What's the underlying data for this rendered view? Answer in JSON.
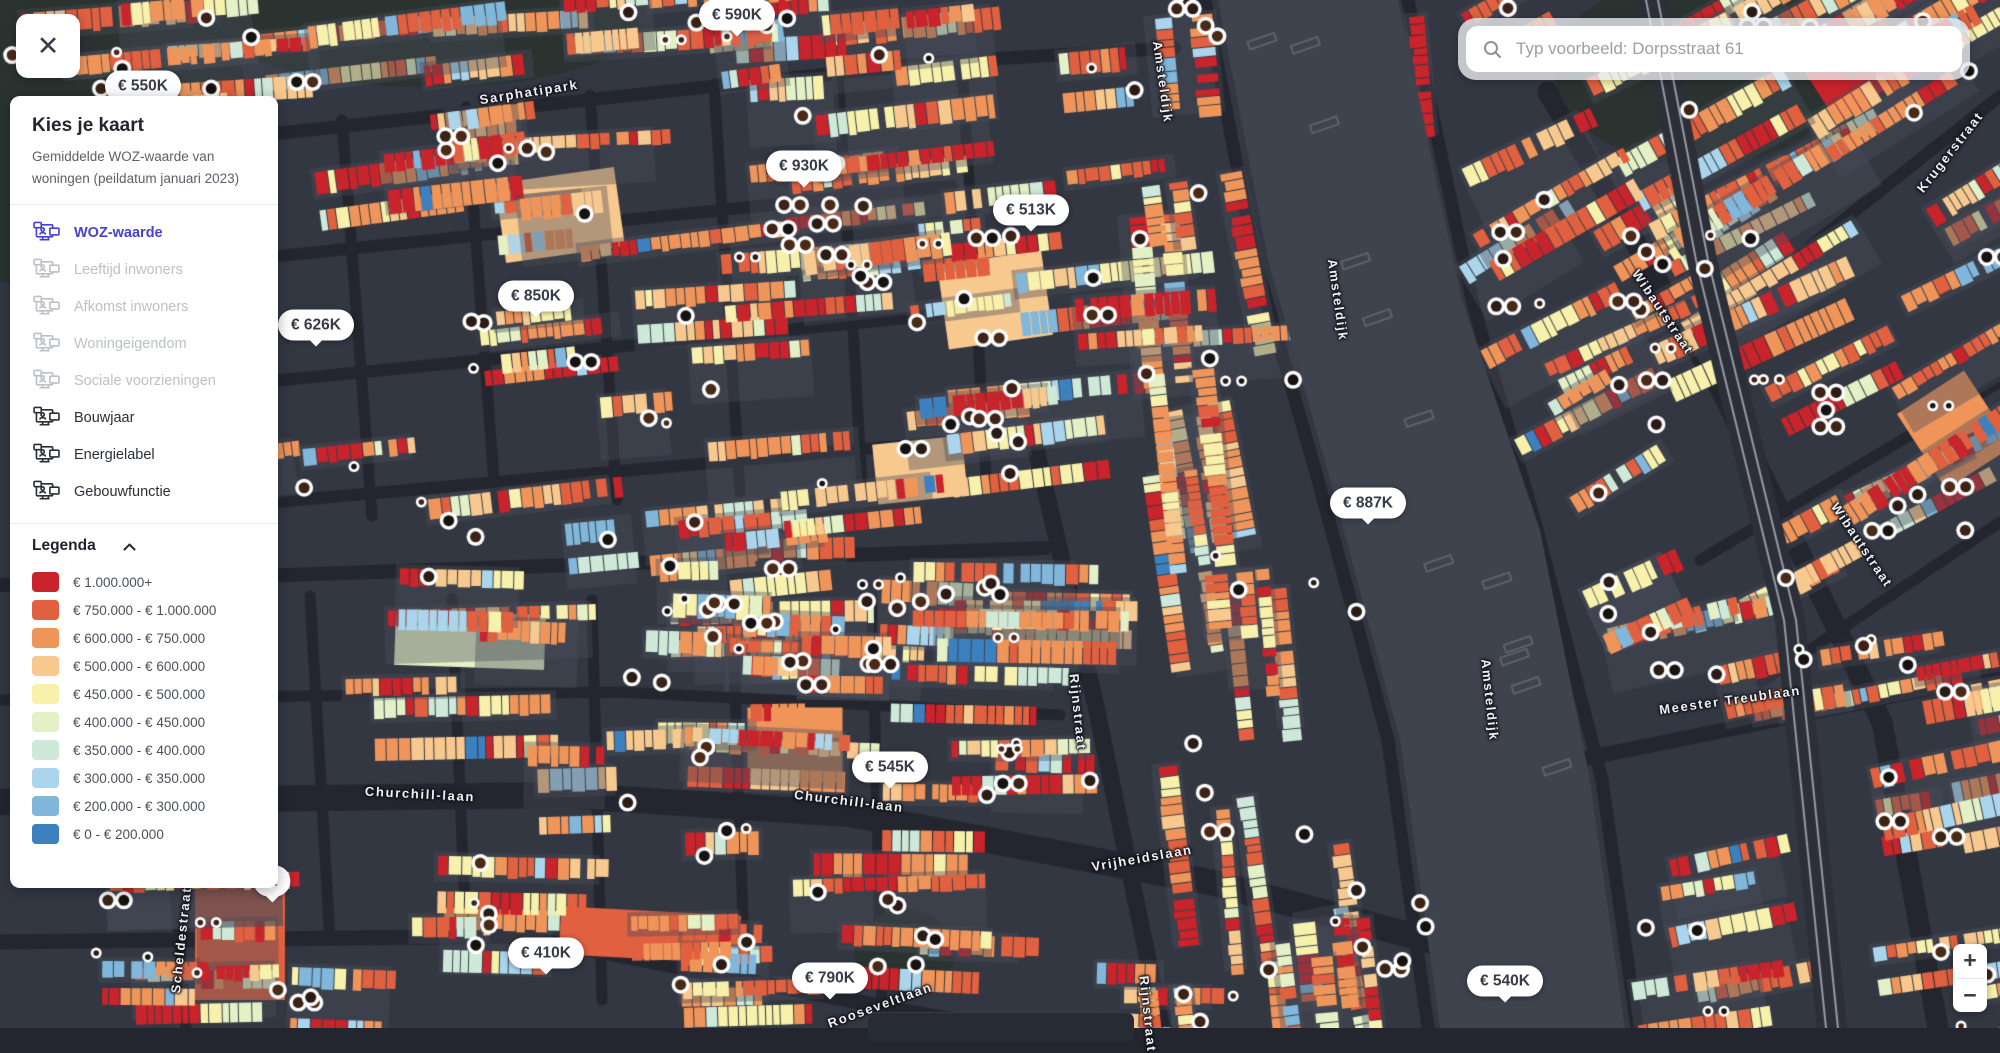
{
  "panel": {
    "title": "Kies je kaart",
    "subtitle": "Gemiddelde WOZ-waarde van woningen (peildatum januari 2023)",
    "accent_color": "#4741d0",
    "items": [
      {
        "label": "WOZ-waarde",
        "state": "active"
      },
      {
        "label": "Leeftijd inwoners",
        "state": "disabled"
      },
      {
        "label": "Afkomst inwoners",
        "state": "disabled"
      },
      {
        "label": "Woningeigendom",
        "state": "disabled"
      },
      {
        "label": "Sociale voorzieningen",
        "state": "disabled"
      },
      {
        "label": "Bouwjaar",
        "state": "normal"
      },
      {
        "label": "Energielabel",
        "state": "normal"
      },
      {
        "label": "Gebouwfunctie",
        "state": "normal"
      }
    ],
    "legend": {
      "title": "Legenda",
      "entries": [
        {
          "color": "#c9232b",
          "label": "€ 1.000.000+"
        },
        {
          "color": "#e0603f",
          "label": "€ 750.000 - € 1.000.000"
        },
        {
          "color": "#f0955a",
          "label": "€ 600.000 - € 750.000"
        },
        {
          "color": "#f8c98f",
          "label": "€ 500.000 - € 600.000"
        },
        {
          "color": "#f7f1ac",
          "label": "€ 450.000 - € 500.000"
        },
        {
          "color": "#e4f0c5",
          "label": "€ 400.000 - € 450.000"
        },
        {
          "color": "#cfe9d8",
          "label": "€ 350.000 - € 400.000"
        },
        {
          "color": "#abd5ec",
          "label": "€ 300.000 - € 350.000"
        },
        {
          "color": "#80b7da",
          "label": "€ 200.000 - € 300.000"
        },
        {
          "color": "#3d80bf",
          "label": "€ 0 - € 200.000"
        }
      ]
    }
  },
  "search": {
    "placeholder": "Typ voorbeeld: Dorpsstraat 61"
  },
  "icons": {
    "close": "✕",
    "zoom_in": "+",
    "zoom_out": "−"
  },
  "map": {
    "price_labels": [
      {
        "text": "€ 550K",
        "x": 143,
        "y": 86
      },
      {
        "text": "€ 590K",
        "x": 737,
        "y": 15
      },
      {
        "text": "€ 930K",
        "x": 804,
        "y": 166
      },
      {
        "text": "€ 513K",
        "x": 1031,
        "y": 210
      },
      {
        "text": "€ 850K",
        "x": 536,
        "y": 296
      },
      {
        "text": "€ 626K",
        "x": 316,
        "y": 325
      },
      {
        "text": "€ 887K",
        "x": 1368,
        "y": 503
      },
      {
        "text": "€ 545K",
        "x": 890,
        "y": 767
      },
      {
        "text": "€ 410K",
        "x": 546,
        "y": 953
      },
      {
        "text": "€ 790K",
        "x": 830,
        "y": 978
      },
      {
        "text": "€ 540K",
        "x": 1505,
        "y": 981
      },
      {
        "text": "K",
        "x": 272,
        "y": 881
      }
    ],
    "street_labels": [
      {
        "text": "Sarphatipark",
        "x": 529,
        "y": 92,
        "angle": -9
      },
      {
        "text": "Amsteldijk",
        "x": 1163,
        "y": 82,
        "angle": 82
      },
      {
        "text": "Amsteldijk",
        "x": 1338,
        "y": 300,
        "angle": 82
      },
      {
        "text": "Amsteldijk",
        "x": 1490,
        "y": 700,
        "angle": 84
      },
      {
        "text": "Wibautstraat",
        "x": 1663,
        "y": 312,
        "angle": 56
      },
      {
        "text": "Wibautstraat",
        "x": 1862,
        "y": 545,
        "angle": 56
      },
      {
        "text": "Krugerstraat",
        "x": 1950,
        "y": 152,
        "angle": -52
      },
      {
        "text": "Rijnstraat",
        "x": 1078,
        "y": 712,
        "angle": 84
      },
      {
        "text": "Rijnstraat",
        "x": 1148,
        "y": 1014,
        "angle": 84
      },
      {
        "text": "Churchill-laan",
        "x": 420,
        "y": 794,
        "angle": 3
      },
      {
        "text": "Churchill-laan",
        "x": 849,
        "y": 801,
        "angle": 7
      },
      {
        "text": "Vrijheidslaan",
        "x": 1142,
        "y": 858,
        "angle": -10
      },
      {
        "text": "Meester Treublaan",
        "x": 1730,
        "y": 700,
        "angle": -8
      },
      {
        "text": "Scheldestraat",
        "x": 181,
        "y": 940,
        "angle": -84
      },
      {
        "text": "Rooseveltlaan",
        "x": 880,
        "y": 1005,
        "angle": -20
      }
    ],
    "colors": {
      "land": "#23262e",
      "block": "#333742",
      "river": "#3f434d",
      "park": "#2a3330",
      "building_palette": [
        "#c9232b",
        "#e0603f",
        "#f0955a",
        "#f8c98f",
        "#f7f1ac",
        "#e4f0c5",
        "#cfe9d8",
        "#abd5ec",
        "#80b7da",
        "#3d80bf"
      ]
    }
  }
}
